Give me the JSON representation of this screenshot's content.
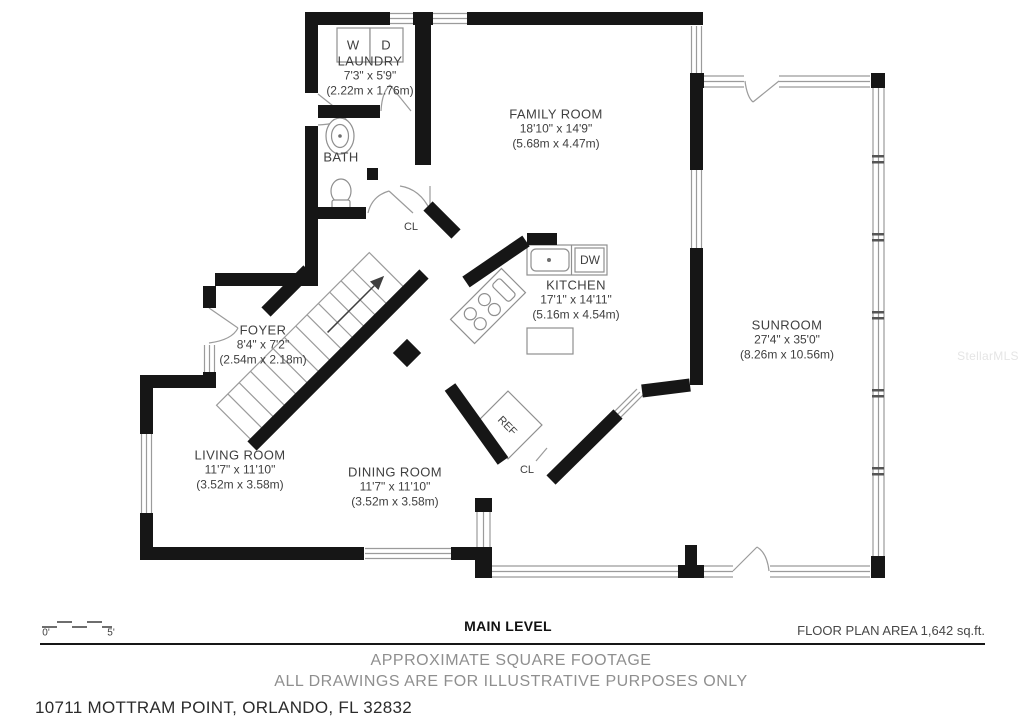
{
  "plan": {
    "watermark": "StellarMLS",
    "rooms": {
      "laundry": {
        "name": "LAUNDRY",
        "dims": "7'3\" x 5'9\"",
        "metric": "(2.22m x 1.76m)"
      },
      "bath": {
        "name": "BATH"
      },
      "family": {
        "name": "FAMILY ROOM",
        "dims": "18'10\" x 14'9\"",
        "metric": "(5.68m x 4.47m)"
      },
      "kitchen": {
        "name": "KITCHEN",
        "dims": "17'1\" x 14'11\"",
        "metric": "(5.16m x 4.54m)"
      },
      "sunroom": {
        "name": "SUNROOM",
        "dims": "27'4\" x 35'0\"",
        "metric": "(8.26m x 10.56m)"
      },
      "foyer": {
        "name": "FOYER",
        "dims": "8'4\" x 7'2\"",
        "metric": "(2.54m x 2.18m)"
      },
      "living": {
        "name": "LIVING ROOM",
        "dims": "11'7\" x 11'10\"",
        "metric": "(3.52m x 3.58m)"
      },
      "dining": {
        "name": "DINING ROOM",
        "dims": "11'7\" x 11'10\"",
        "metric": "(3.52m x 3.58m)"
      }
    },
    "fixtures": {
      "washer": "W",
      "dryer": "D",
      "dishwasher": "DW",
      "refrigerator": "REF",
      "closet_hall": "CL",
      "closet_dining": "CL"
    },
    "scale_bar": {
      "start": "0'",
      "end": "5'"
    }
  },
  "footer": {
    "level_title": "MAIN LEVEL",
    "area_note": "FLOOR PLAN AREA 1,642 sq.ft.",
    "disclaimer_line1": "APPROXIMATE SQUARE FOOTAGE",
    "disclaimer_line2": "ALL DRAWINGS ARE FOR ILLUSTRATIVE PURPOSES ONLY",
    "address": "10711 MOTTRAM POINT, ORLANDO, FL 32832"
  },
  "colors": {
    "wall": "#161616",
    "thin_line": "#9b9b9b",
    "label_text": "#3f3f3f",
    "footer_muted": "#8f8f8f",
    "footer_dark": "#2b2b2b",
    "watermark": "#e5e5e5"
  }
}
